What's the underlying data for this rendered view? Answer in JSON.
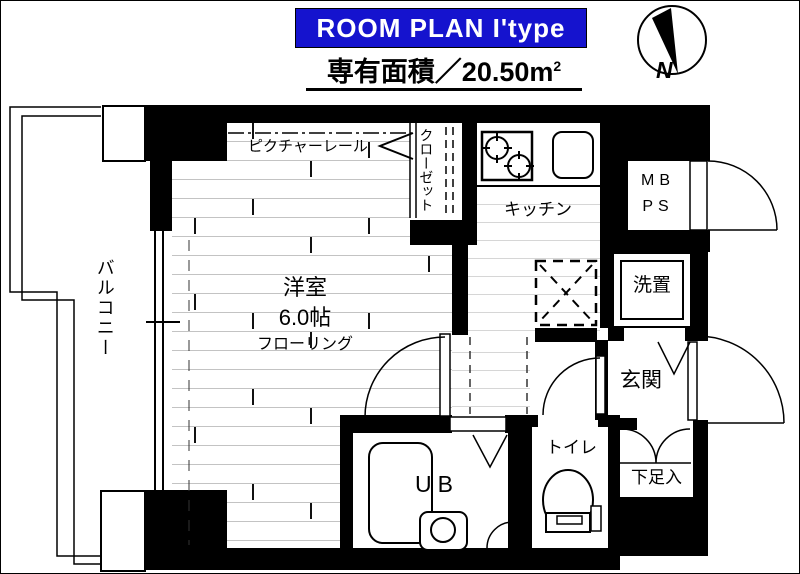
{
  "header": {
    "banner_text": "ROOM PLAN  I'type",
    "banner_bg": "#1513ce",
    "banner_text_color": "#ffffff",
    "area_text": "専有面積／20.50m",
    "area_sup": "2",
    "compass_label": "N"
  },
  "labels": {
    "balcony": "バルコニー",
    "picture_rail": "ピクチャーレール",
    "closet": "クローゼット",
    "kitchen": "キッチン",
    "meter_box": "MB",
    "pipe_space": "PS",
    "washer": "洗置",
    "room_name": "洋室",
    "room_size": "6.0帖",
    "room_floor": "フローリング",
    "entrance": "玄関",
    "shoe_box": "下足入",
    "unit_bath": "UB",
    "toilet": "トイレ"
  },
  "plan_meta": {
    "plan_type": "I'type",
    "exclusive_area": "20.50㎡",
    "main_room_size": "6.0帖"
  },
  "colors": {
    "wall": "#000000",
    "floor_line": "#c3c3c3",
    "banner_blue": "#1513ce"
  }
}
